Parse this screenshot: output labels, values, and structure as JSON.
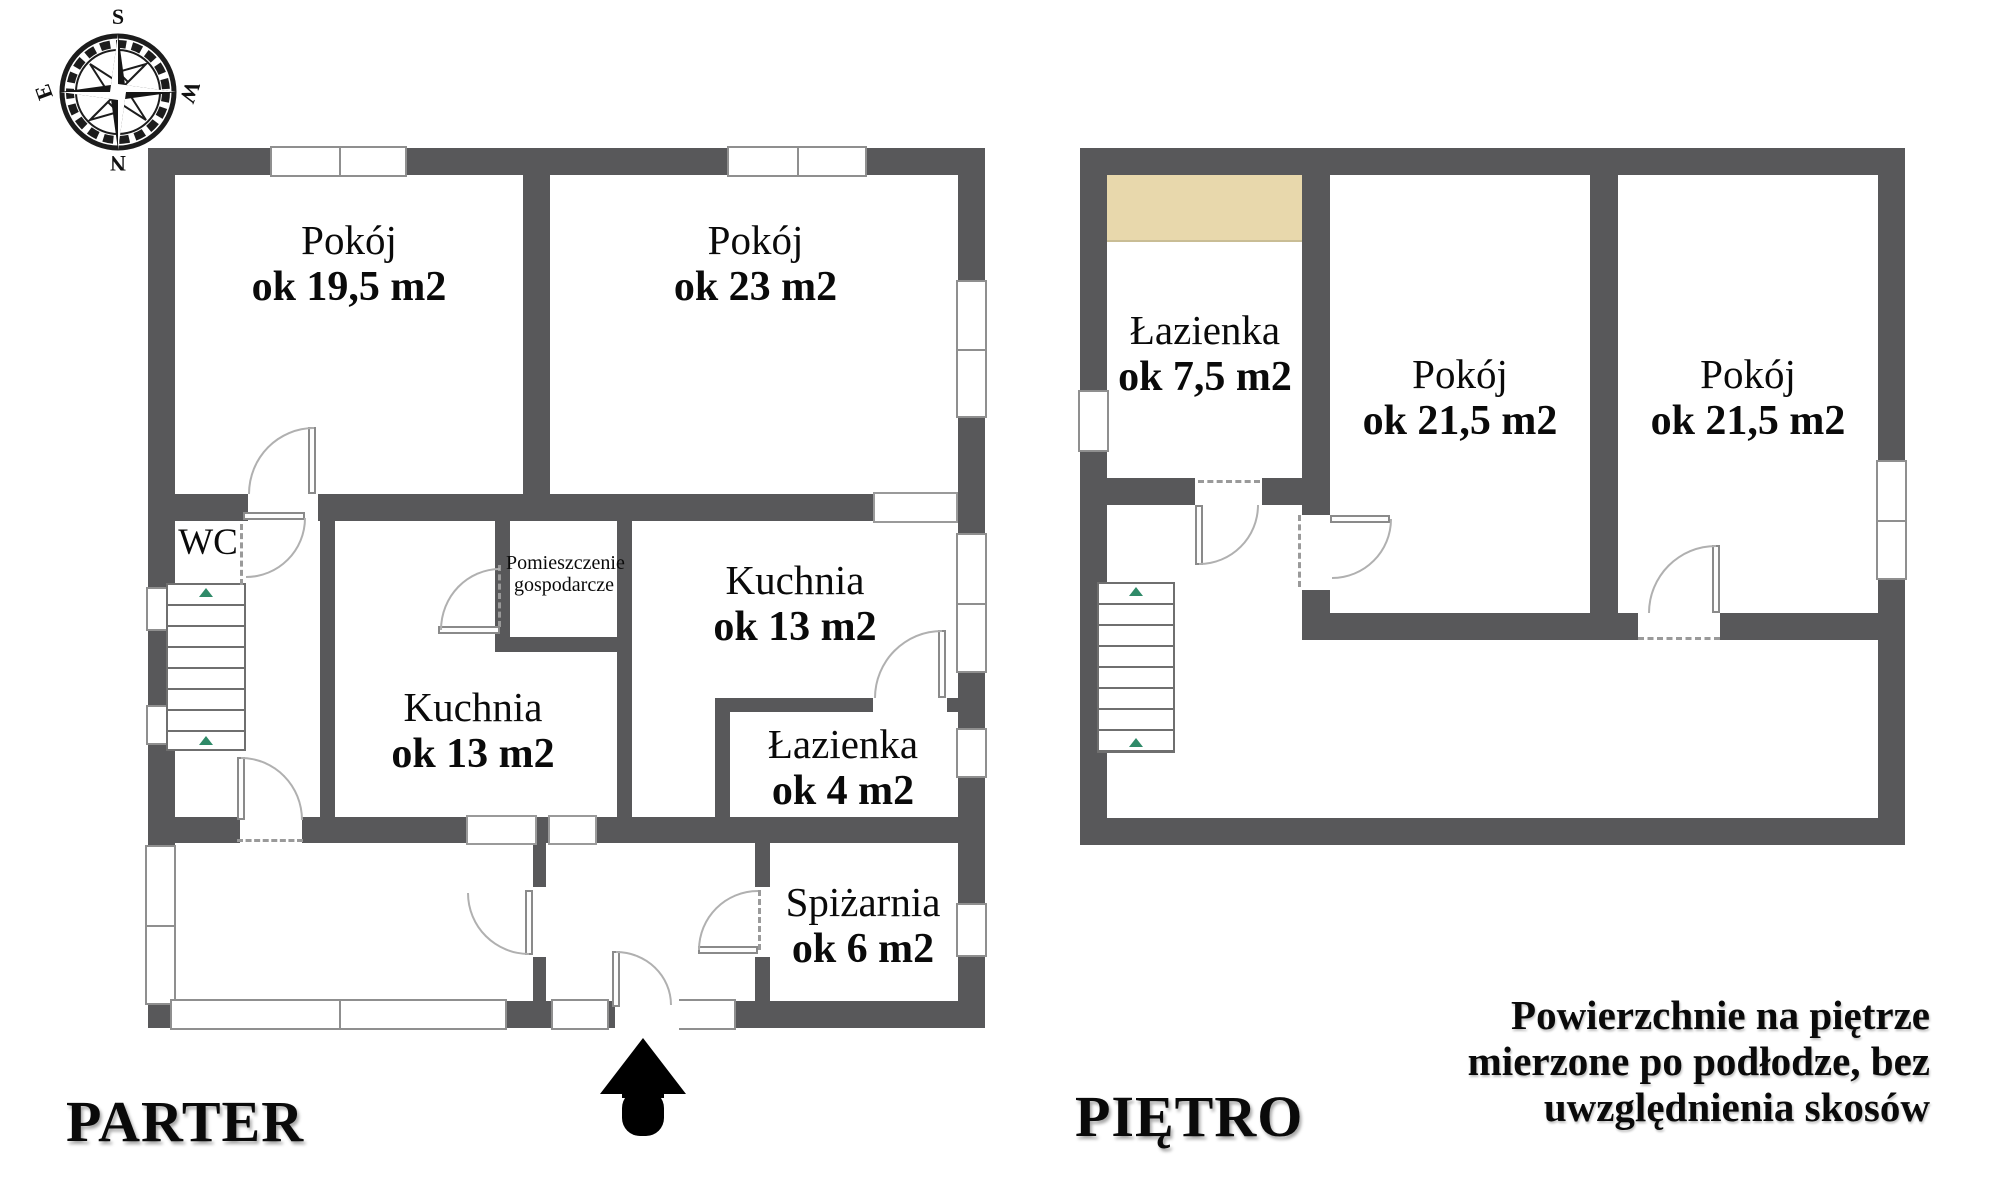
{
  "compass": {
    "north": "N",
    "south": "S",
    "east": "E",
    "west": "W"
  },
  "floors": [
    {
      "id": "parter",
      "label": "PARTER",
      "rooms": [
        {
          "name": "Pokój",
          "area": "ok 19,5 m2"
        },
        {
          "name": "Pokój",
          "area": "ok 23 m2"
        },
        {
          "name": "WC",
          "area": ""
        },
        {
          "name": "Pomieszczenie",
          "name2": "gospodarcze",
          "area": ""
        },
        {
          "name": "Kuchnia",
          "area": "ok 13 m2"
        },
        {
          "name": "Kuchnia",
          "area": "ok 13 m2"
        },
        {
          "name": "Łazienka",
          "area": "ok 4 m2"
        },
        {
          "name": "Spiżarnia",
          "area": "ok 6 m2"
        }
      ]
    },
    {
      "id": "pietro",
      "label": "PIĘTRO",
      "rooms": [
        {
          "name": "Łazienka",
          "area": "ok 7,5 m2"
        },
        {
          "name": "Pokój",
          "area": "ok 21,5 m2"
        },
        {
          "name": "Pokój",
          "area": "ok 21,5 m2"
        }
      ]
    }
  ],
  "note": {
    "line1": "Powierzchnie na piętrze",
    "line2": "mierzone po podłodze, bez",
    "line3": "uwzględnienia skosów"
  },
  "colors": {
    "wall": "#58585a",
    "attic_slope": "#e8d8ac",
    "stair_marker_green": "#2f8a68"
  }
}
